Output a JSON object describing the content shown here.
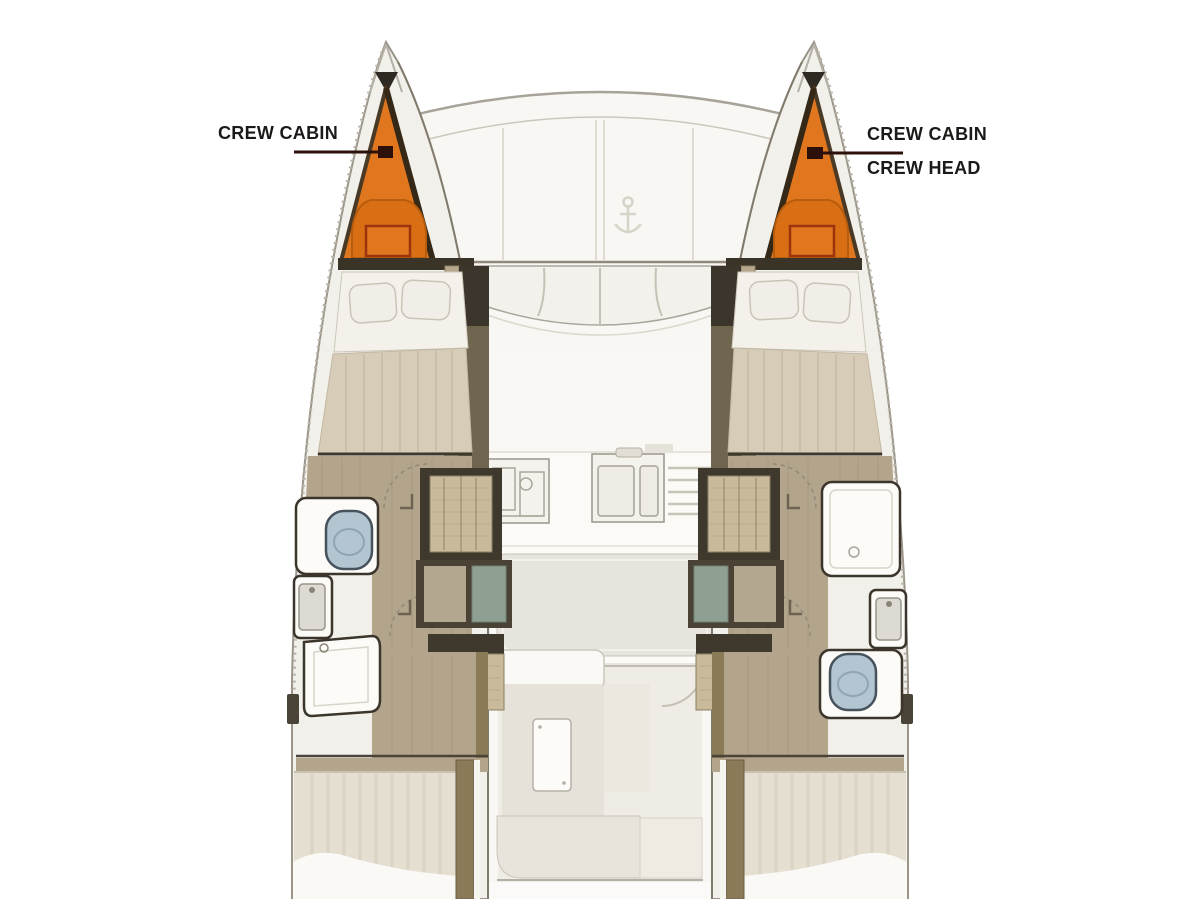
{
  "callouts": {
    "left": {
      "lines": [
        "CREW CABIN"
      ]
    },
    "right": {
      "lines": [
        "CREW CABIN",
        "CREW HEAD"
      ]
    }
  },
  "colors": {
    "crew_cabin_fill": "#E0771F",
    "crew_cabin_shadow": "#D96F15",
    "crew_cabin_outline": "#4A3A25",
    "leader_line": "#2E100A",
    "label_text": "#1C1A18",
    "toilet_blue": "#B3C5D1",
    "wood_floor": "#B3A48C",
    "duvet": "#D6CCB7",
    "aft_duvet": "#E5DFD2",
    "wicker": "#C9BA9B",
    "teal_panel": "#8FA093",
    "olive_furniture": "#70654F",
    "dark_trim": "#3B352B",
    "hull_shell": "#F2F0EB",
    "deck_white": "#F8F7F3",
    "cockpit_floor": "#EFECE5",
    "table_top": "#E7E4DD"
  },
  "icons": {
    "anchor_windlass": "anchor-windlass-icon",
    "toilet": "toilet-icon",
    "sink": "sink-icon",
    "shower": "shower-icon",
    "stove": "stove-icon",
    "leader_dot": "callout-dot-icon"
  }
}
